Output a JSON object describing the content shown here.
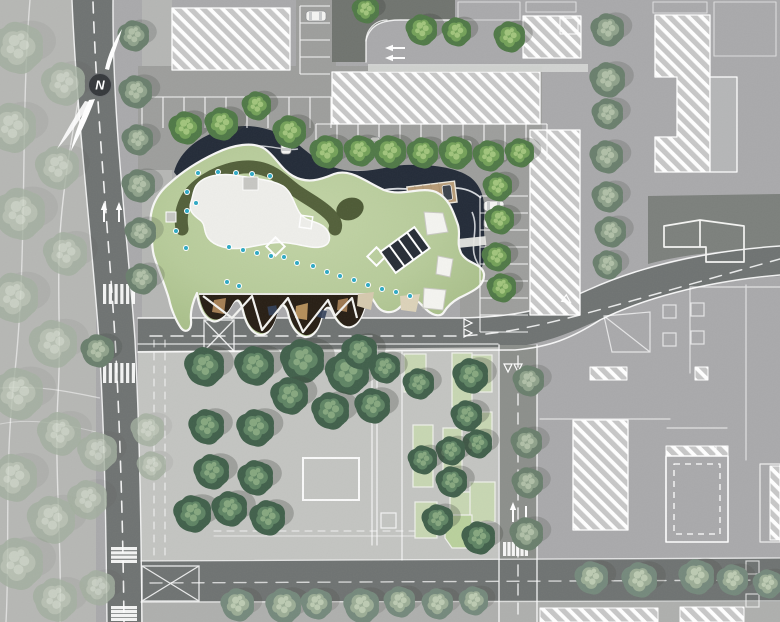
{
  "meta": {
    "north_label": "N",
    "plan_name": "architectural-site-plan"
  },
  "colors": {
    "bg": "#a9a9ab",
    "fadedPark": "#b6b7b4",
    "sidewalkStrip": "#b5b6b4",
    "road": "#6f7372",
    "roadLight": "#8c8f8b",
    "drivewayDark": "#70746f",
    "plazaRight": "#7c807c",
    "parkingLot": "#9d9e9c",
    "parkGround": "#c3c4c1",
    "sidewalk": "#aeafad",
    "hatchBase": "#c7c7c7",
    "hatchLine": "#ffffff",
    "buildingGray": "#b5b6b7",
    "whiteBand": "#d8d9d7",
    "pond": "#232b38",
    "ripple": "#e9ebee",
    "bridge": "#e6e6e2",
    "roofLight": "#bdd0a2",
    "roofDark": "#a6bc86",
    "roofOlive": "#4d5a35",
    "plaza": "#eeeeea",
    "graySquare": "#c6c6c2",
    "canopyDark": "#271e14",
    "canopyTan": "#b3885a",
    "canopyTan2": "#c49a62",
    "canopyNavy": "#33405a",
    "tanWedge": "#d5c9ae",
    "tanWedge2": "#dcd2b9",
    "deck": "#b79b77",
    "deckEdge": "#ece7dc",
    "dot": "#2fa9c4",
    "glazeDark": "#272d36",
    "carBody": "#f4f4f2",
    "carLine": "#8e9092",
    "carGlass": "#c9cbcc",
    "carDark": "#3c424b",
    "north": "#35383b",
    "line": "#ffffff",
    "planterGreen": "#c7d6b2",
    "planterGreen2": "#b9d09c"
  },
  "palettes": {
    "faded": {
      "base": "#a3af9f",
      "mid": "#b8c2b2",
      "hi": "#cdd5c7",
      "shadow": 0.08,
      "opacity": 0.8
    },
    "muted": {
      "base": "#6a7f6d",
      "mid": "#8fa28b",
      "hi": "#b0bfa7",
      "shadow": 0.2
    },
    "street": {
      "base": "#507947",
      "mid": "#74a159",
      "hi": "#a1c47c",
      "shadow": 0.28
    },
    "park": {
      "base": "#41604b",
      "mid": "#5f8464",
      "hi": "#86a77f",
      "shadow": 0.28
    },
    "row": {
      "base": "#75897c",
      "mid": "#9cad96",
      "hi": "#bccab2",
      "shadow": 0.16
    }
  },
  "site": {
    "trees": {
      "faded": [
        [
          18,
          48,
          25
        ],
        [
          64,
          84,
          21
        ],
        [
          12,
          128,
          24
        ],
        [
          58,
          168,
          21
        ],
        [
          20,
          214,
          25
        ],
        [
          66,
          254,
          21
        ],
        [
          14,
          298,
          24
        ],
        [
          54,
          344,
          23
        ],
        [
          18,
          394,
          25
        ],
        [
          60,
          434,
          21
        ],
        [
          14,
          478,
          23
        ],
        [
          52,
          520,
          23
        ],
        [
          18,
          564,
          25
        ],
        [
          56,
          600,
          21
        ],
        [
          98,
          452,
          19
        ],
        [
          88,
          500,
          19
        ],
        [
          98,
          588,
          17
        ],
        [
          148,
          430,
          16
        ],
        [
          152,
          466,
          14
        ]
      ],
      "muted": [
        [
          134,
          36,
          15
        ],
        [
          136,
          92,
          16
        ],
        [
          138,
          140,
          15
        ],
        [
          139,
          186,
          16
        ],
        [
          141,
          233,
          15
        ],
        [
          142,
          279,
          15
        ],
        [
          98,
          351,
          16
        ],
        [
          608,
          30,
          16
        ],
        [
          608,
          80,
          17
        ],
        [
          608,
          114,
          15
        ],
        [
          607,
          157,
          16
        ],
        [
          608,
          197,
          15
        ],
        [
          611,
          232,
          15
        ],
        [
          608,
          265,
          14
        ],
        [
          529,
          381,
          15
        ],
        [
          527,
          443,
          15
        ],
        [
          528,
          483,
          15
        ],
        [
          527,
          534,
          16
        ]
      ],
      "street": [
        [
          186,
          128,
          16
        ],
        [
          222,
          124,
          16
        ],
        [
          257,
          106,
          14
        ],
        [
          290,
          132,
          16
        ],
        [
          327,
          152,
          16
        ],
        [
          360,
          151,
          15
        ],
        [
          390,
          152,
          16
        ],
        [
          423,
          153,
          15
        ],
        [
          456,
          153,
          16
        ],
        [
          489,
          156,
          15
        ],
        [
          520,
          153,
          14
        ],
        [
          498,
          187,
          14
        ],
        [
          500,
          220,
          14
        ],
        [
          497,
          257,
          14
        ],
        [
          502,
          288,
          14
        ],
        [
          366,
          10,
          13
        ],
        [
          422,
          30,
          15
        ],
        [
          457,
          32,
          14
        ],
        [
          510,
          37,
          15
        ]
      ],
      "park": [
        [
          205,
          367,
          19
        ],
        [
          255,
          366,
          19
        ],
        [
          303,
          361,
          21
        ],
        [
          348,
          373,
          21
        ],
        [
          360,
          352,
          17
        ],
        [
          385,
          368,
          15
        ],
        [
          290,
          396,
          18
        ],
        [
          331,
          411,
          18
        ],
        [
          373,
          406,
          17
        ],
        [
          207,
          427,
          17
        ],
        [
          256,
          428,
          18
        ],
        [
          212,
          472,
          17
        ],
        [
          256,
          478,
          17
        ],
        [
          193,
          514,
          18
        ],
        [
          230,
          509,
          17
        ],
        [
          268,
          518,
          17
        ],
        [
          419,
          384,
          15
        ],
        [
          471,
          376,
          17
        ],
        [
          467,
          416,
          15
        ],
        [
          478,
          444,
          14
        ],
        [
          451,
          451,
          14
        ],
        [
          423,
          460,
          14
        ],
        [
          452,
          482,
          15
        ],
        [
          438,
          520,
          15
        ],
        [
          479,
          538,
          16
        ]
      ],
      "row": [
        [
          238,
          605,
          16
        ],
        [
          284,
          606,
          17
        ],
        [
          317,
          604,
          15
        ],
        [
          362,
          606,
          17
        ],
        [
          400,
          602,
          15
        ],
        [
          438,
          604,
          15
        ],
        [
          474,
          601,
          14
        ],
        [
          592,
          578,
          16
        ],
        [
          640,
          580,
          17
        ],
        [
          697,
          577,
          17
        ],
        [
          733,
          580,
          15
        ],
        [
          768,
          584,
          14
        ]
      ]
    },
    "roof_dots": [
      [
        198,
        173
      ],
      [
        218,
        172
      ],
      [
        236,
        173
      ],
      [
        252,
        174
      ],
      [
        270,
        176
      ],
      [
        187,
        192
      ],
      [
        196,
        203
      ],
      [
        187,
        211
      ],
      [
        176,
        231
      ],
      [
        186,
        248
      ],
      [
        229,
        247
      ],
      [
        243,
        250
      ],
      [
        257,
        253
      ],
      [
        271,
        256
      ],
      [
        284,
        257
      ],
      [
        297,
        263
      ],
      [
        313,
        266
      ],
      [
        327,
        272
      ],
      [
        340,
        276
      ],
      [
        354,
        280
      ],
      [
        368,
        285
      ],
      [
        382,
        289
      ],
      [
        396,
        292
      ],
      [
        227,
        282
      ],
      [
        239,
        286
      ],
      [
        410,
        296
      ]
    ],
    "planters": [
      [
        404,
        354,
        22,
        38
      ],
      [
        413,
        425,
        20,
        62
      ],
      [
        415,
        502,
        22,
        36
      ],
      [
        452,
        353,
        20,
        54
      ],
      [
        443,
        428,
        19,
        57
      ],
      [
        450,
        492,
        23,
        38
      ],
      [
        472,
        355,
        20,
        37
      ],
      [
        473,
        412,
        19,
        33
      ],
      [
        470,
        482,
        25,
        40
      ]
    ],
    "crosswalks": [
      {
        "x": 103,
        "y": 284,
        "w": 32,
        "h": 20,
        "orient": "v",
        "bars": 6
      },
      {
        "x": 103,
        "y": 363,
        "w": 32,
        "h": 20,
        "orient": "v",
        "bars": 6
      },
      {
        "x": 111,
        "y": 547,
        "w": 26,
        "h": 16,
        "orient": "h",
        "bars": 4
      },
      {
        "x": 111,
        "y": 606,
        "w": 26,
        "h": 15,
        "orient": "h",
        "bars": 4
      },
      {
        "x": 503,
        "y": 542,
        "w": 25,
        "h": 14,
        "orient": "v",
        "bars": 6
      }
    ],
    "stalls": [
      {
        "x": 142,
        "y": 97,
        "count": 9,
        "spacing": 21,
        "len": 31,
        "dir": "v"
      },
      {
        "x": 316,
        "y": 124,
        "count": 11,
        "spacing": 21,
        "len": 36,
        "dir": "v"
      },
      {
        "x": 480,
        "y": 196,
        "count": 8,
        "spacing": 17,
        "len": 48,
        "dir": "h"
      },
      {
        "x": 300,
        "y": 6,
        "count": 4,
        "spacing": 17,
        "len": 30,
        "dir": "h"
      }
    ],
    "cars": [
      [
        188,
        130,
        0
      ],
      [
        286,
        144,
        0
      ],
      [
        375,
        147,
        0
      ],
      [
        467,
        150,
        0
      ],
      [
        494,
        206,
        90
      ],
      [
        494,
        223,
        90
      ],
      [
        316,
        16,
        90
      ]
    ],
    "arrows": [
      [
        104,
        214,
        "up"
      ],
      [
        119,
        214,
        "up"
      ],
      [
        397,
        48,
        "left"
      ],
      [
        397,
        58,
        "left"
      ],
      [
        513,
        514,
        "up"
      ],
      [
        526,
        514,
        "down"
      ]
    ],
    "triangles": [
      [
        464,
        323,
        0
      ],
      [
        464,
        333,
        0
      ],
      [
        508,
        364,
        90
      ],
      [
        518,
        364,
        90
      ],
      [
        564,
        298,
        35
      ]
    ]
  }
}
